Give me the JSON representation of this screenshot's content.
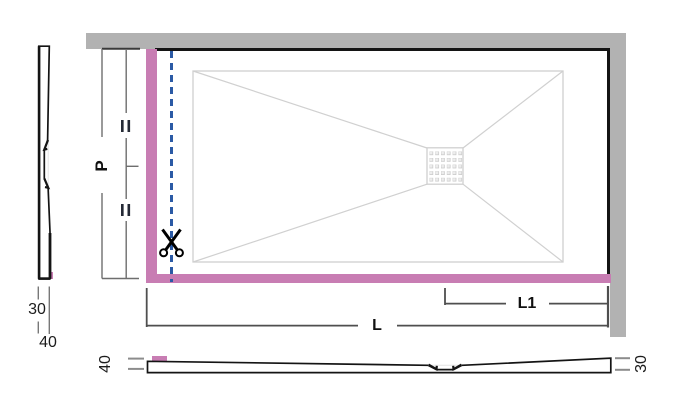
{
  "plan_view": {
    "depth_dim": {
      "label": "P",
      "equal_top": "=",
      "equal_bottom": "="
    },
    "length_dim": {
      "label": "L"
    },
    "drain_dim": {
      "label": "L1"
    }
  },
  "side_section": {
    "dims": [
      "30",
      "40"
    ]
  },
  "front_section": {
    "left": "40",
    "right": "30"
  },
  "icons": {
    "scissors": "✂",
    "drain_grate": "grid-of-holes"
  },
  "colors": {
    "cut_edge": "#c87db3",
    "cut_line": "#2b5aa5",
    "wall": "#b2b2b2",
    "outline": "#141414",
    "basin_line": "#d0d0d0"
  }
}
